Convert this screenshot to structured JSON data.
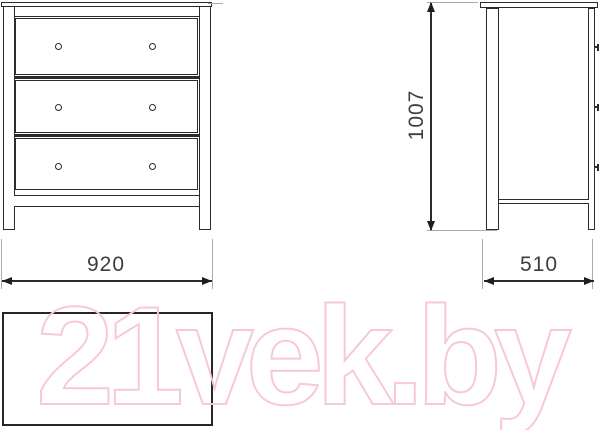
{
  "drawing": {
    "dimensions": {
      "width_mm": "920",
      "height_mm": "1007",
      "depth_mm": "510"
    },
    "views": {
      "front": {
        "drawers": 3,
        "knobs_per_drawer": 2
      },
      "side": {
        "knob_profiles": 3
      },
      "top": {
        "shape": "rectangle"
      }
    },
    "style": {
      "line_color": "#2b2b2b",
      "extension_line_color": "#ababab",
      "dimension_text_color": "#3d3d3d"
    }
  },
  "watermark": {
    "text": "21vek.by",
    "color": "#f7c9d3"
  }
}
